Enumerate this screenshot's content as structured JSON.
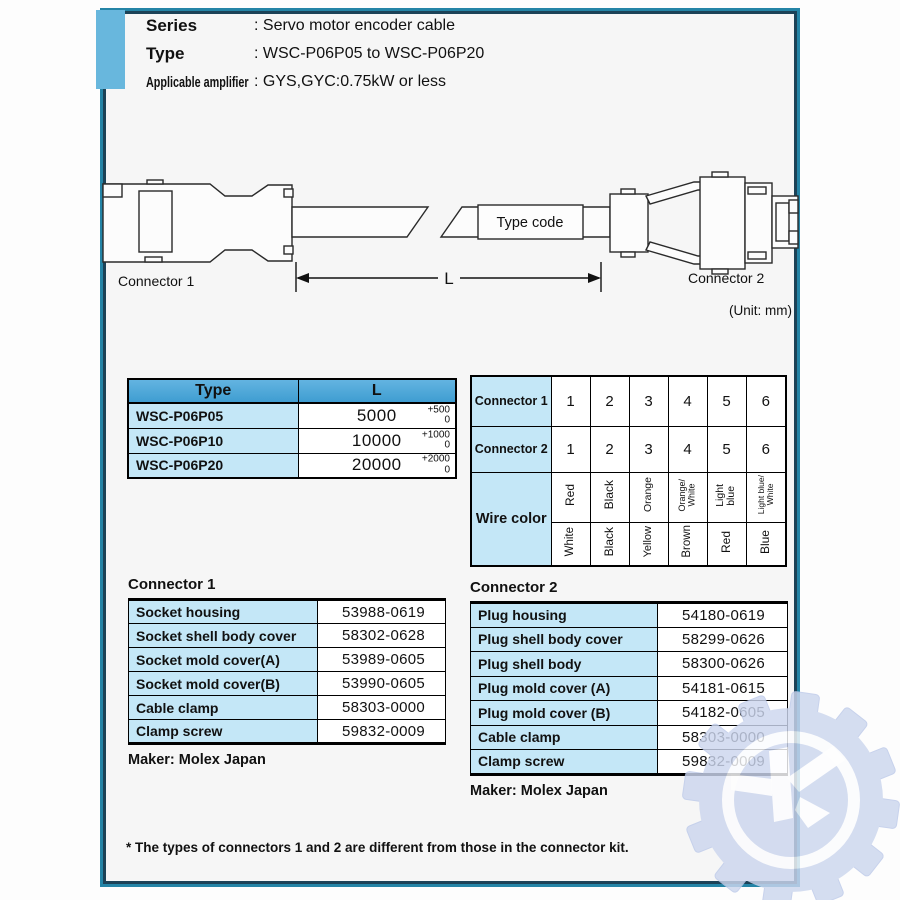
{
  "header": {
    "rows": [
      {
        "label": "Series",
        "value": ": Servo motor encoder cable"
      },
      {
        "label": "Type",
        "value": ": WSC-P06P05 to WSC-P06P20"
      },
      {
        "label": "Applicable amplifier",
        "value": ": GYS,GYC:0.75kW or less"
      }
    ]
  },
  "diagram": {
    "connector1_label": "Connector 1",
    "connector2_label": "Connector 2",
    "type_code_label": "Type code",
    "length_symbol": "L",
    "unit_note": "(Unit: mm)"
  },
  "length_table": {
    "col_type": "Type",
    "col_l": "L",
    "rows": [
      {
        "type": "WSC-P06P05",
        "l": "5000",
        "tol_plus": "+500",
        "tol_zero": "0"
      },
      {
        "type": "WSC-P06P10",
        "l": "10000",
        "tol_plus": "+1000",
        "tol_zero": "0"
      },
      {
        "type": "WSC-P06P20",
        "l": "20000",
        "tol_plus": "+2000",
        "tol_zero": "0"
      }
    ]
  },
  "pin_table": {
    "row1_label": "Connector 1",
    "row2_label": "Connector 2",
    "wire_label": "Wire color",
    "connector1_pins": [
      "1",
      "2",
      "3",
      "4",
      "5",
      "6"
    ],
    "connector2_pins": [
      "1",
      "2",
      "3",
      "4",
      "5",
      "6"
    ],
    "wire_row1": [
      "Red",
      "Black",
      "Orange",
      "Orange/\nWhite",
      "Light\nblue",
      "Light blue/\nWhite"
    ],
    "wire_row2": [
      "White",
      "Black",
      "Yellow",
      "Brown",
      "Red",
      "Blue"
    ]
  },
  "connector1_parts": {
    "title": "Connector 1",
    "rows": [
      [
        "Socket housing",
        "53988-0619"
      ],
      [
        "Socket shell body cover",
        "58302-0628"
      ],
      [
        "Socket mold cover(A)",
        "53989-0605"
      ],
      [
        "Socket mold cover(B)",
        "53990-0605"
      ],
      [
        "Cable clamp",
        "58303-0000"
      ],
      [
        "Clamp screw",
        "59832-0009"
      ]
    ],
    "maker": "Maker: Molex Japan"
  },
  "connector2_parts": {
    "title": "Connector 2",
    "rows": [
      [
        "Plug housing",
        "54180-0619"
      ],
      [
        "Plug shell body cover",
        "58299-0626"
      ],
      [
        "Plug shell body",
        "58300-0626"
      ],
      [
        "Plug mold cover (A)",
        "54181-0615"
      ],
      [
        "Plug mold cover (B)",
        "54182-0605"
      ],
      [
        "Cable clamp",
        "58303-0000"
      ],
      [
        "Clamp screw",
        "59832-0009"
      ]
    ],
    "maker": "Maker: Molex Japan"
  },
  "footnote": "* The types of connectors 1 and 2 are different from those in the connector kit.",
  "watermark": {
    "letter": "K"
  },
  "colors": {
    "frame_outer": "#2484a6",
    "frame_inner": "#1c4257",
    "accent_bar": "#68b7dd",
    "table_header_blue": "#4fa8da",
    "cell_light_blue": "#c4e7f7",
    "watermark_blue": "#ccd6ee"
  }
}
